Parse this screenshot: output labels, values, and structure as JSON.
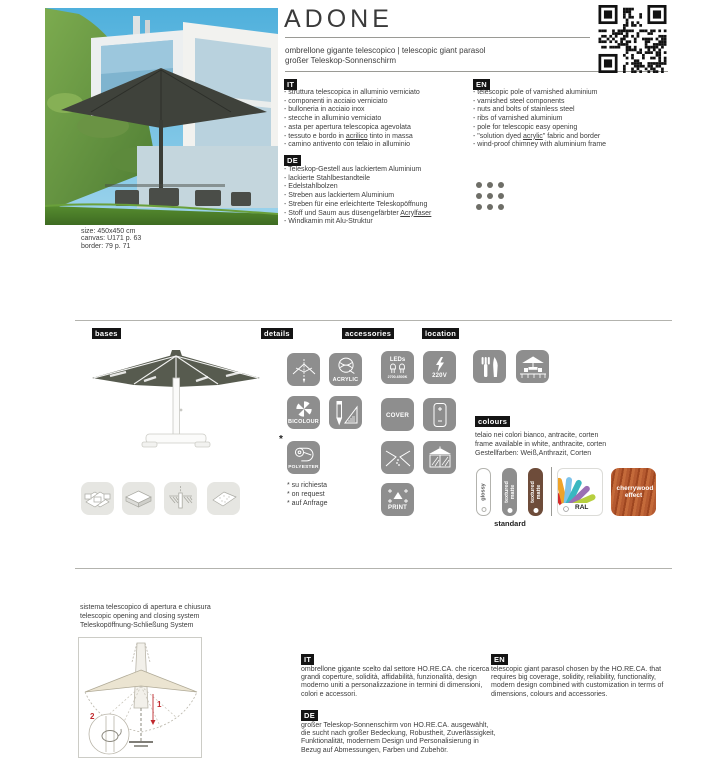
{
  "header": {
    "title": "ADONE",
    "subtitle_it_en": "ombrellone gigante telescopico | telescopic giant parasol",
    "subtitle_de": "großer Teleskop-Sonnenschirm"
  },
  "photo": {
    "size_line": "size: 450x450 cm",
    "canvas_line": "canvas: U171 p. 63",
    "border_line": "border: 79 p. 71"
  },
  "features": {
    "it": {
      "label": "IT",
      "items": [
        "- struttura telescopica in alluminio verniciato",
        "- componenti in acciaio verniciato",
        "- bulloneria in acciaio inox",
        "- stecche in alluminio verniciato",
        "- asta per apertura telescopica agevolata",
        "- tessuto e bordo in acrilico tinto in massa",
        "- camino antivento con telaio in alluminio"
      ]
    },
    "en": {
      "label": "EN",
      "items": [
        "- telescopic pole of varnished aluminium",
        "- varnished steel components",
        "- nuts and bolts of stainless steel",
        "- ribs of varnished aluminium",
        "- pole for telescopic easy opening",
        "- \"solution dyed acrylic\" fabric and border",
        "- wind-proof chimney with aluminium frame"
      ]
    },
    "de": {
      "label": "DE",
      "items": [
        "- Teleskop-Gestell aus lackiertem Aluminium",
        "- lackierte Stahlbestandteile",
        "- Edelstahlbolzen",
        "- Streben aus lackiertem Aluminium",
        "- Streben für eine erleichterte Teleskopöffnung",
        "- Stoff und Saum aus düsengefärbter Acrylfaser",
        "- Windkamin mit Alu-Struktur"
      ]
    }
  },
  "section_labels": {
    "bases": "bases",
    "details": "details",
    "accessories": "accessories",
    "location": "location",
    "colours": "colours"
  },
  "details_section": {
    "acrylic_label": "ACRYLIC",
    "bicolour_label": "BICOLOUR",
    "polyester_label": "POLYESTER",
    "polyester_asterisk": "*",
    "notes": [
      "* su richiesta",
      "* on request",
      "* auf Anfrage"
    ]
  },
  "accessories_section": {
    "led_label": "LEDs",
    "led_range": "2700-6500K",
    "volt_label": "220V",
    "cover_label": "COVER",
    "print_label": "PRINT"
  },
  "colours_section": {
    "desc_it": "telaio nei colori bianco, antracite, corten",
    "desc_en": "frame available in white, anthracite, corten",
    "desc_de": "Gestellfarben: Weiß,Anthrazit, Corten",
    "swatch_glossy": "glossy",
    "swatch_textured_grey": "textured matte",
    "swatch_textured_corten": "textured matte",
    "standard_label": "standard",
    "ral_label": "RAL",
    "cherrywood_label": "cherrywood effect"
  },
  "telescopic_system": {
    "line_it": "sistema telescopico di apertura e chiusura",
    "line_en": "telescopic opening and closing system",
    "line_de": "Teleskopöffnung-Schließung System",
    "marker_1": "1",
    "marker_2": "2"
  },
  "descriptions": {
    "it": {
      "label": "IT",
      "text": "ombrellone gigante scelto dal settore HO.RE.CA. che ricerca grandi coperture, solidità, affidabilità, funzionalità, design moderno uniti a personalizzazione in termini di dimensioni, colori e accessori."
    },
    "en": {
      "label": "EN",
      "text": "telescopic giant parasol chosen by the HO.RE.CA. that requires big coverage, solidity, reliability, functionality, modern design combined with customization in terms of dimensions, colours and accessories."
    },
    "de": {
      "label": "DE",
      "text": "großer Teleskop-Sonnenschirm von HO.RE.CA. ausgewählt, die sucht nach großer Bedeckung, Robustheit, Zuverlässigkeit, Funktionalität, modernem Design und Personalisierung in Bezug auf Abmessungen, Farben und Zubehör."
    }
  },
  "colors": {
    "tile_gray": "#8e8e8e",
    "tile_light": "#e6e6e2",
    "label_bg": "#141414",
    "canopy": "#575b4f",
    "corten": "#6e4c3a",
    "cherrywood": "#b55a30",
    "marker_red": "#c0282d"
  }
}
